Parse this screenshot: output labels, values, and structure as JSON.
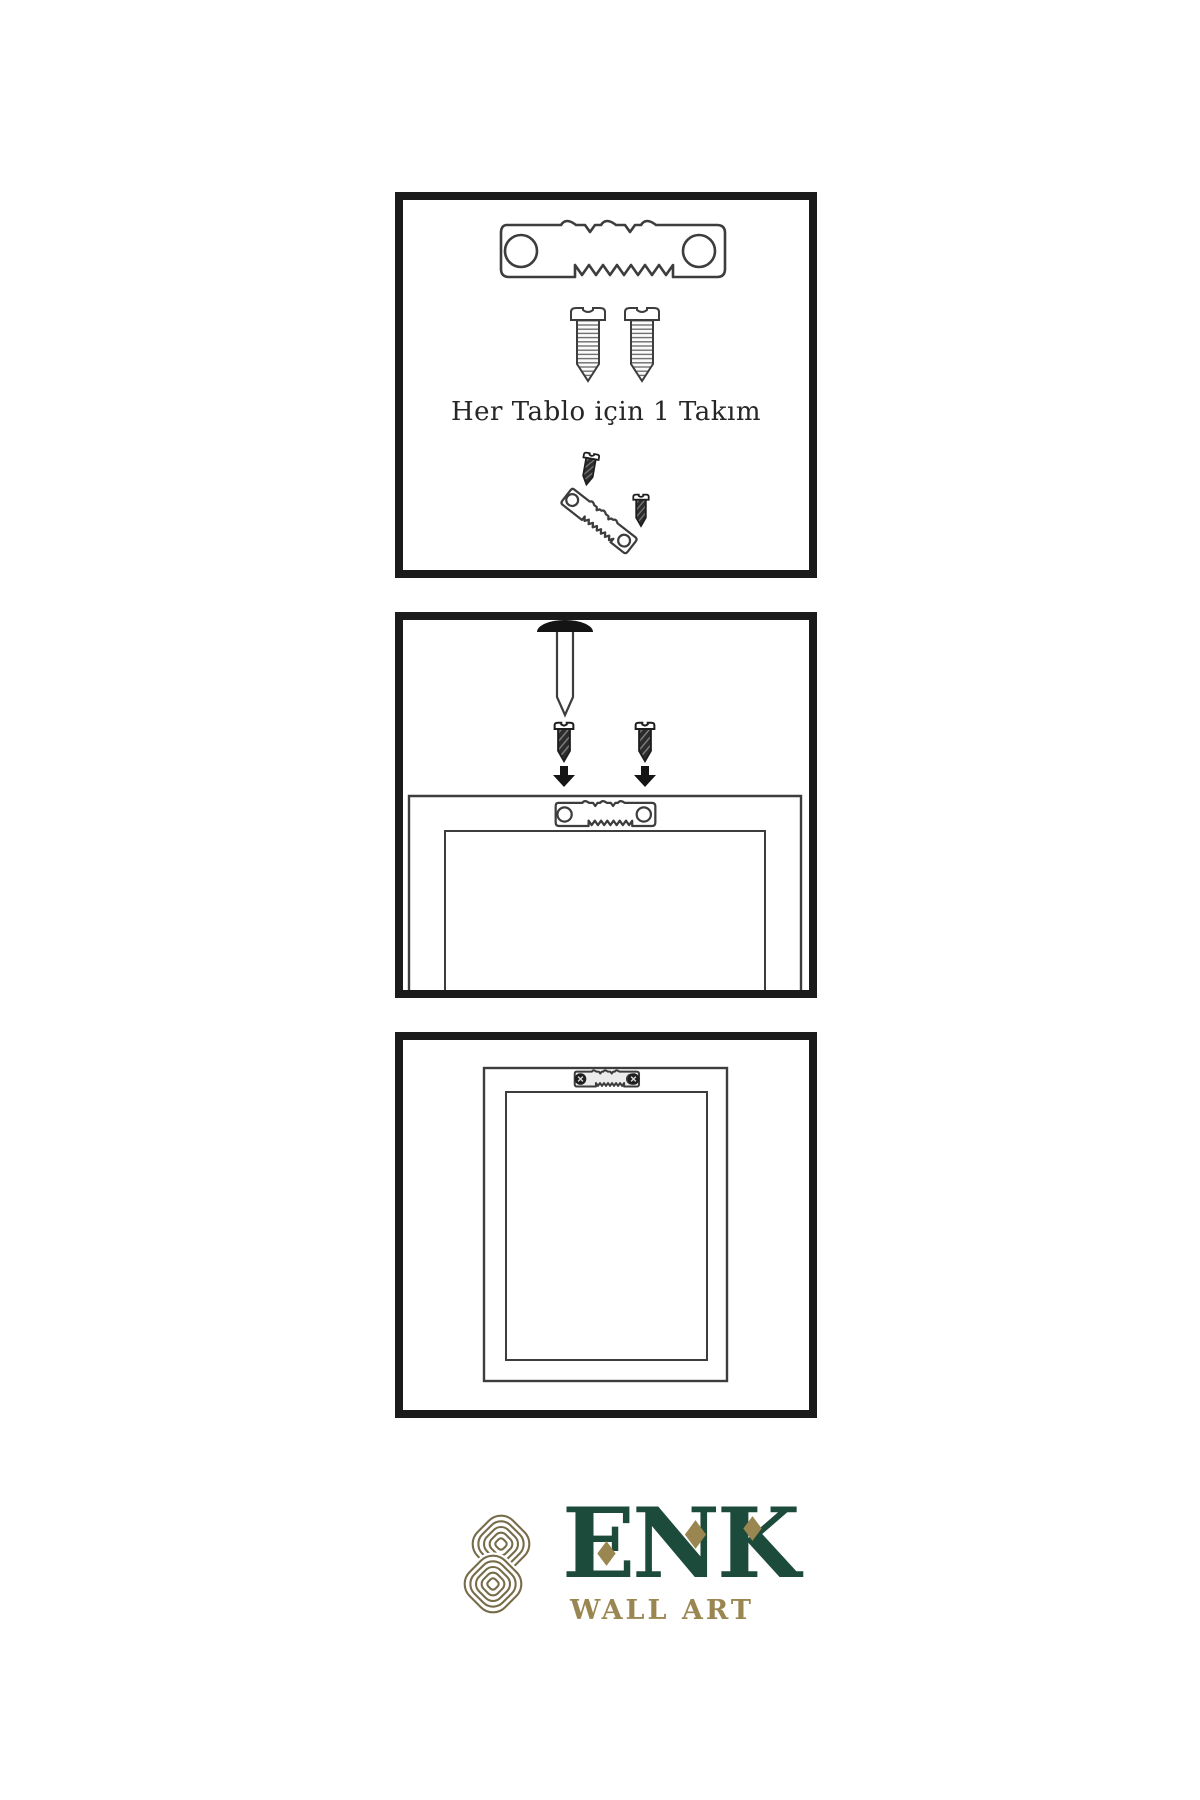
{
  "panels": {
    "step1": {
      "caption": "Her Tablo için 1 Takım"
    },
    "step2": {},
    "step3": {}
  },
  "logo": {
    "brand": "ENK",
    "subtitle": "WALL ART"
  },
  "colors": {
    "page_bg": "#ffffff",
    "panel_border": "#1b1b1b",
    "line_art": "#3d3d3d",
    "screw_dark": "#2c2c2c",
    "brand_green": "#1c4a3b",
    "brand_gold": "#9a8650",
    "knot_gold": "#766c49"
  },
  "icons": {
    "step1": [
      "sawtooth-hanger-icon",
      "mounting-screw-icon",
      "mounting-screw-icon",
      "screw-into-hanger-icon",
      "angled-sawtooth-hanger-icon"
    ],
    "step2": [
      "wall-nail-icon",
      "mounting-screw-icon",
      "mounting-screw-icon",
      "down-arrow-icon",
      "down-arrow-icon",
      "frame-back-icon",
      "sawtooth-hanger-icon"
    ],
    "step3": [
      "frame-back-icon",
      "installed-sawtooth-hanger-icon"
    ],
    "logo": [
      "knot-logo-icon"
    ]
  }
}
